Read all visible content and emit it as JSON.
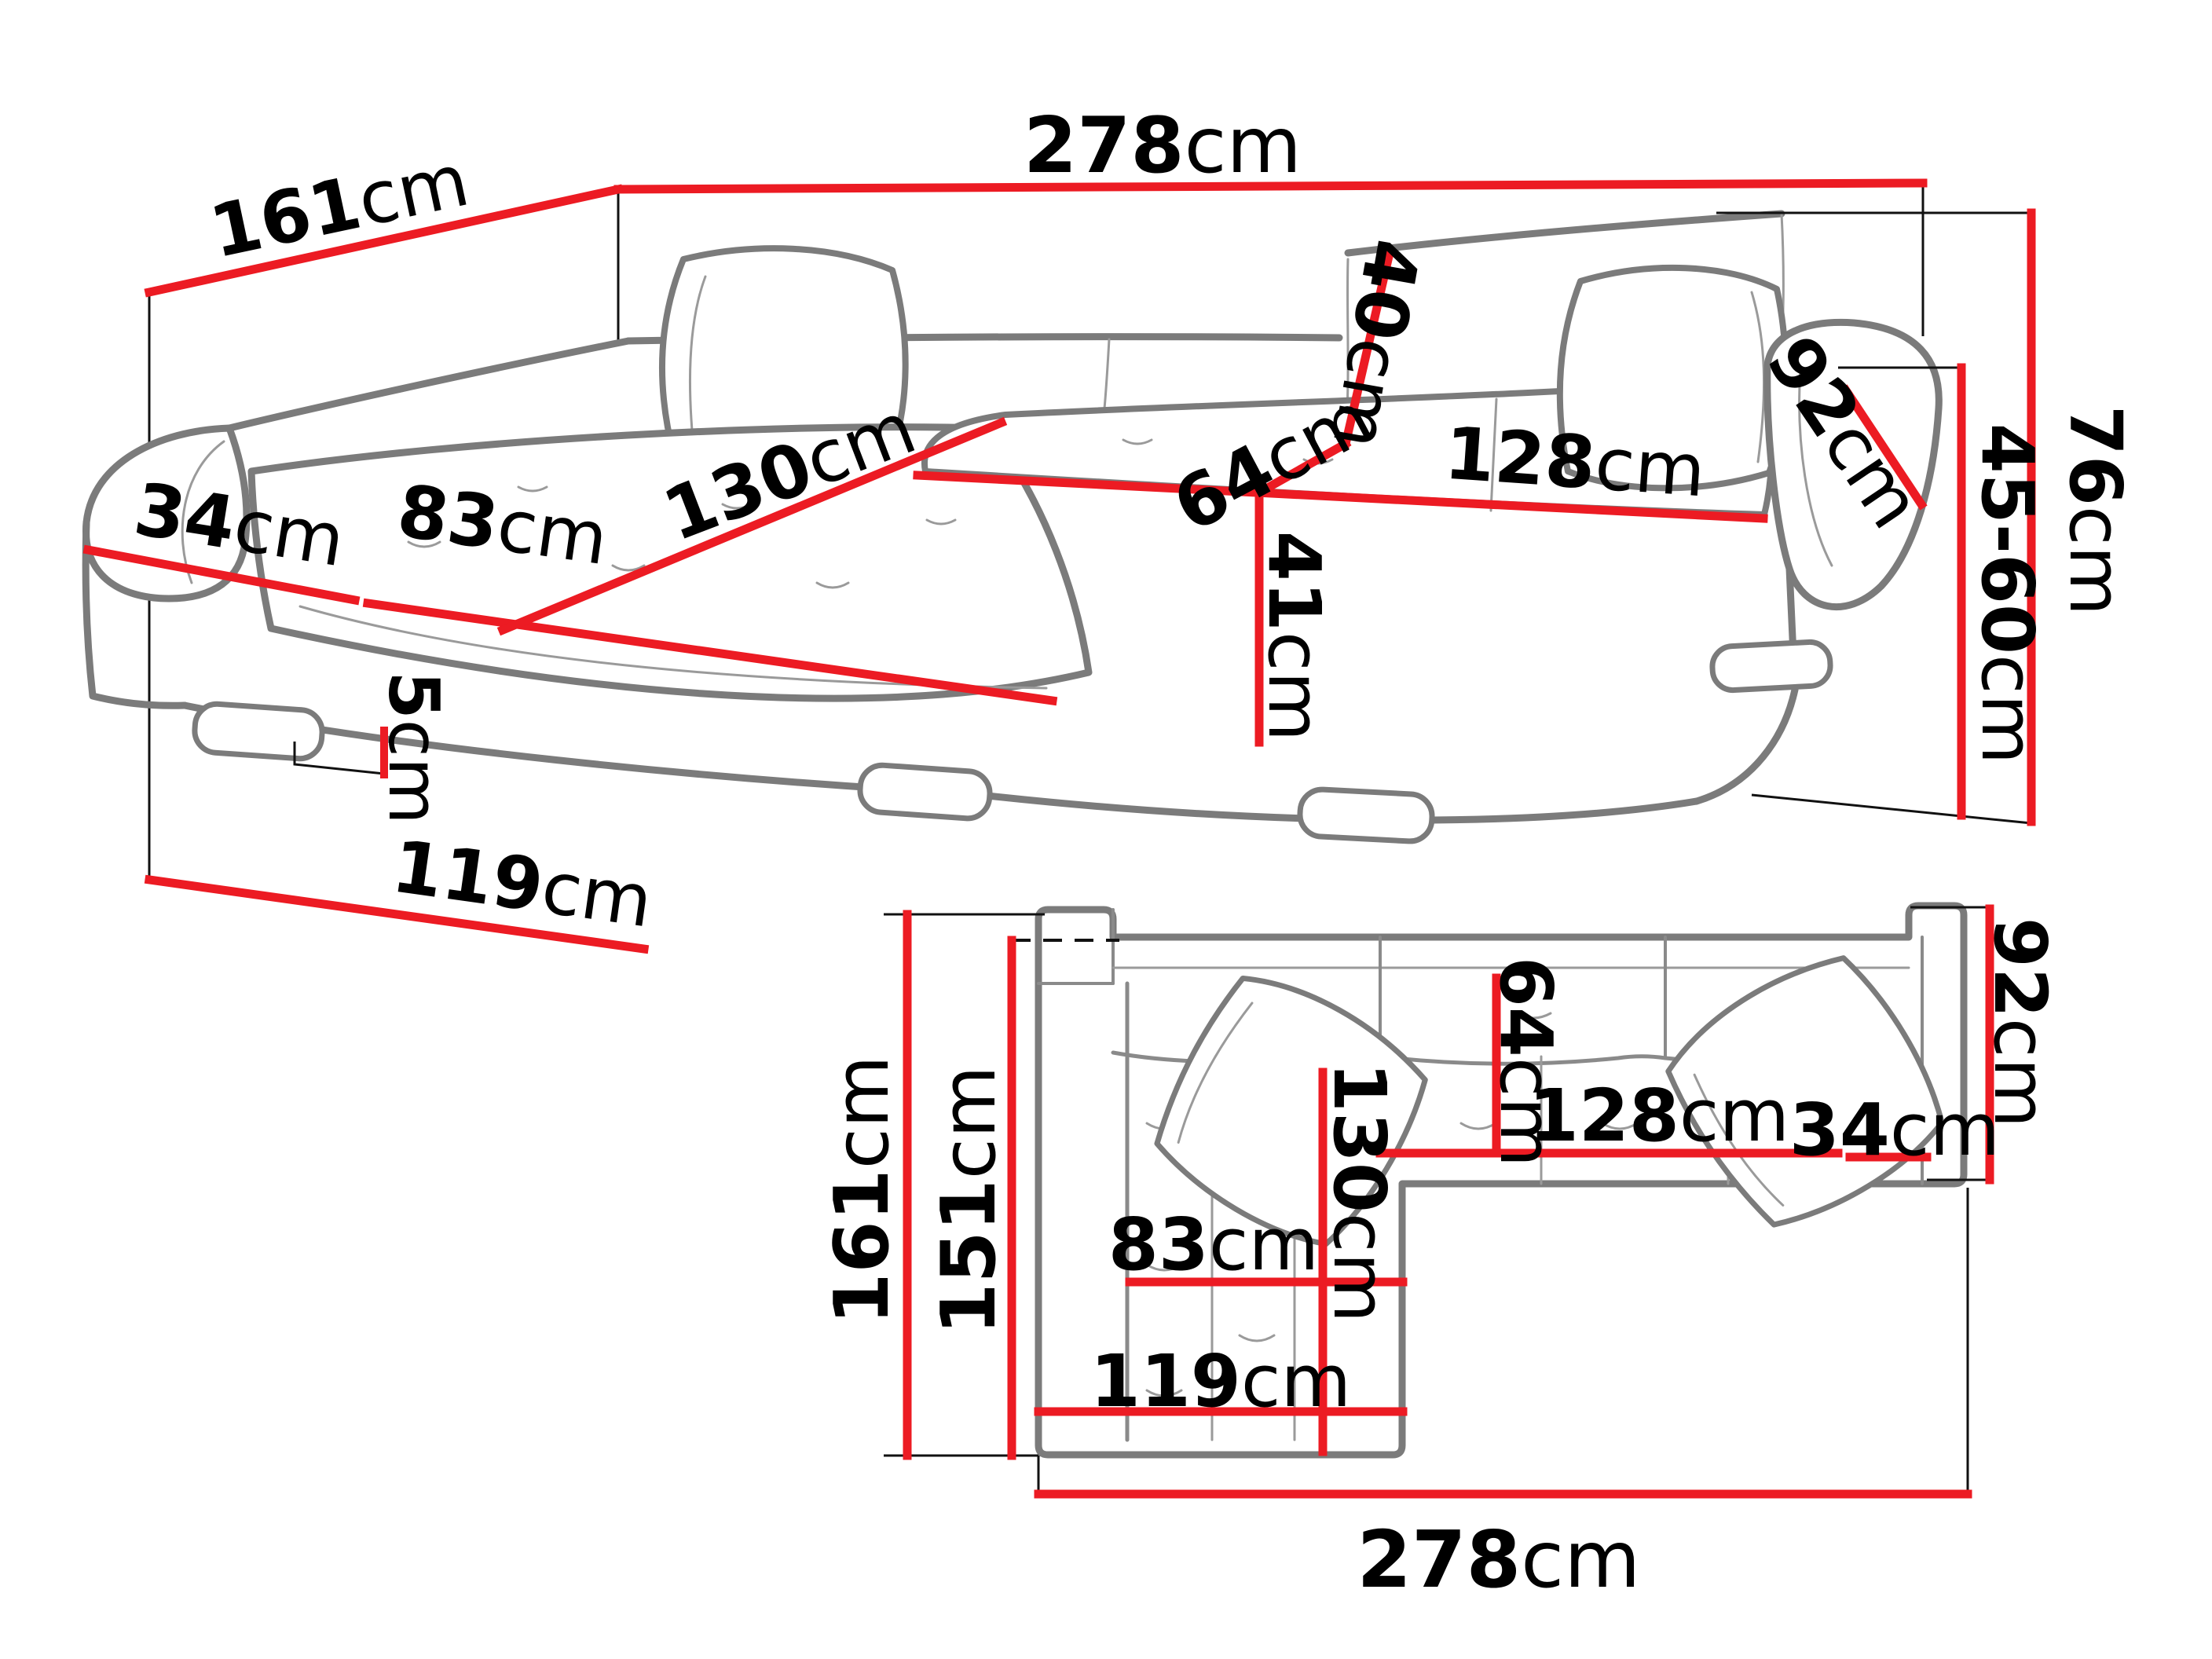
{
  "unit_suffix": "cm",
  "colors": {
    "dimension_line": "#ec1b23",
    "sketch_line": "#7b7b7b",
    "reference_line": "#111111",
    "label_text": "#000000",
    "background": "#ffffff"
  },
  "dims": {
    "p161": {
      "num": "161",
      "unit": "cm"
    },
    "p278": {
      "num": "278",
      "unit": "cm"
    },
    "p34": {
      "num": "34",
      "unit": "cm"
    },
    "p83": {
      "num": "83",
      "unit": "cm"
    },
    "p130": {
      "num": "130",
      "unit": "cm"
    },
    "p64": {
      "num": "64",
      "unit": "cm"
    },
    "p40": {
      "num": "40",
      "unit": "cm"
    },
    "p128": {
      "num": "128",
      "unit": "cm"
    },
    "p41": {
      "num": "41",
      "unit": "cm"
    },
    "p92": {
      "num": "92",
      "unit": "cm"
    },
    "p76": {
      "num": "76",
      "unit": "cm"
    },
    "p45_60": {
      "num": "45-60",
      "unit": "cm"
    },
    "p5": {
      "num": "5",
      "unit": "cm"
    },
    "p119": {
      "num": "119",
      "unit": "cm"
    },
    "q161": {
      "num": "161",
      "unit": "cm"
    },
    "q151": {
      "num": "151",
      "unit": "cm"
    },
    "q130": {
      "num": "130",
      "unit": "cm"
    },
    "q64": {
      "num": "64",
      "unit": "cm"
    },
    "q92": {
      "num": "92",
      "unit": "cm"
    },
    "q128": {
      "num": "128",
      "unit": "cm"
    },
    "q34": {
      "num": "34",
      "unit": "cm"
    },
    "q83": {
      "num": "83",
      "unit": "cm"
    },
    "q119": {
      "num": "119",
      "unit": "cm"
    },
    "q278": {
      "num": "278",
      "unit": "cm"
    }
  }
}
